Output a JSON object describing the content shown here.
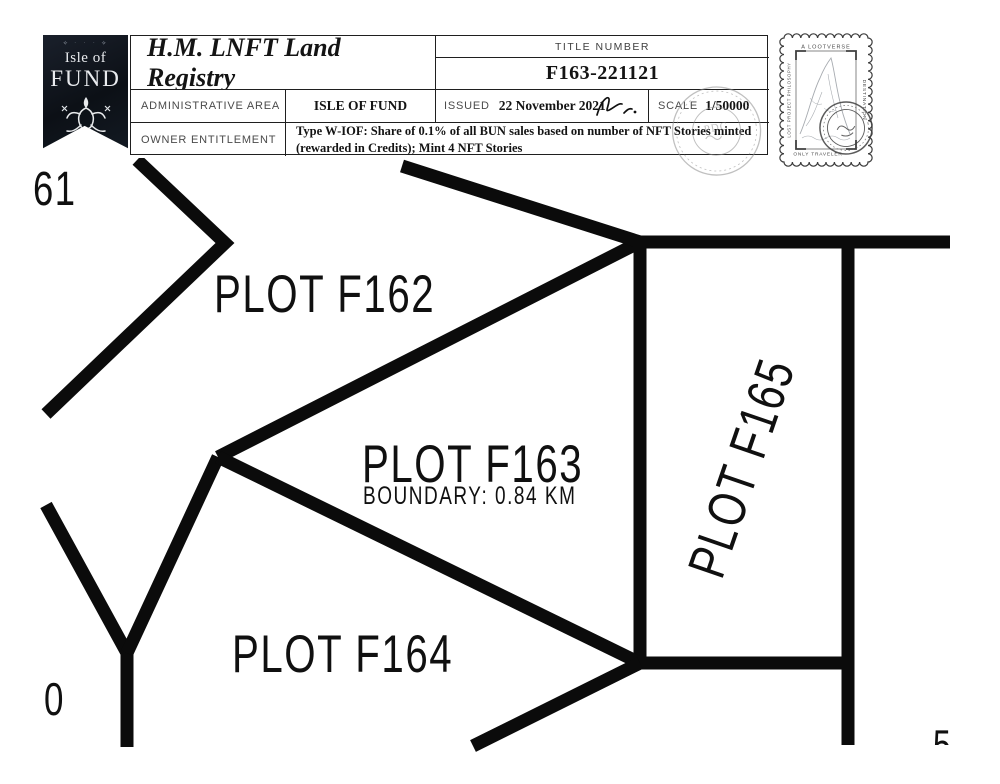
{
  "banner": {
    "ornament": "✧ ᛫ ᛫ ᛫ ✧",
    "top_line": "Isle of",
    "name": "FUND"
  },
  "registry_table": {
    "title": "H.M. LNFT Land Registry",
    "title_number_label": "TITLE NUMBER",
    "title_number": "F163-221121",
    "admin_area_label": "ADMINISTRATIVE AREA",
    "admin_area_value": "ISLE OF FUND",
    "issued_label": "ISSUED",
    "issued_date": "22 November 2021",
    "scale_label": "SCALE",
    "scale_value": "1/50000",
    "owner_label": "OWNER ENTITLEMENT",
    "owner_line1": "Type W-IOF: Share of 0.1% of all BUN sales based on number of NFT Stories minted",
    "owner_line2": "(rewarded in Credits); Mint 4 NFT Stories"
  },
  "seal": {
    "center_text": "PDC"
  },
  "stamp": {
    "top_text": "A LOOTVERSE",
    "right_text": "DESTINATION",
    "left_text": "LOST PROJECT PHILOSOPHY",
    "bottom_text": "ONLY TRAVELER"
  },
  "map": {
    "labels": [
      {
        "id": "plot-f161-partial",
        "text": "61"
      },
      {
        "id": "plot-f162",
        "text": "PLOT F162"
      },
      {
        "id": "plot-f163",
        "text": "PLOT F163"
      },
      {
        "id": "plot-f163-boundary",
        "text": "BOUNDARY: 0.84 KM"
      },
      {
        "id": "plot-f164",
        "text": "PLOT F164"
      },
      {
        "id": "plot-f165",
        "text": "PLOT F165"
      },
      {
        "id": "plot-f160-partial",
        "text": "0"
      },
      {
        "id": "plot-partial-bottom-right",
        "text": "5"
      }
    ],
    "line_color": "#0b0b0b"
  }
}
